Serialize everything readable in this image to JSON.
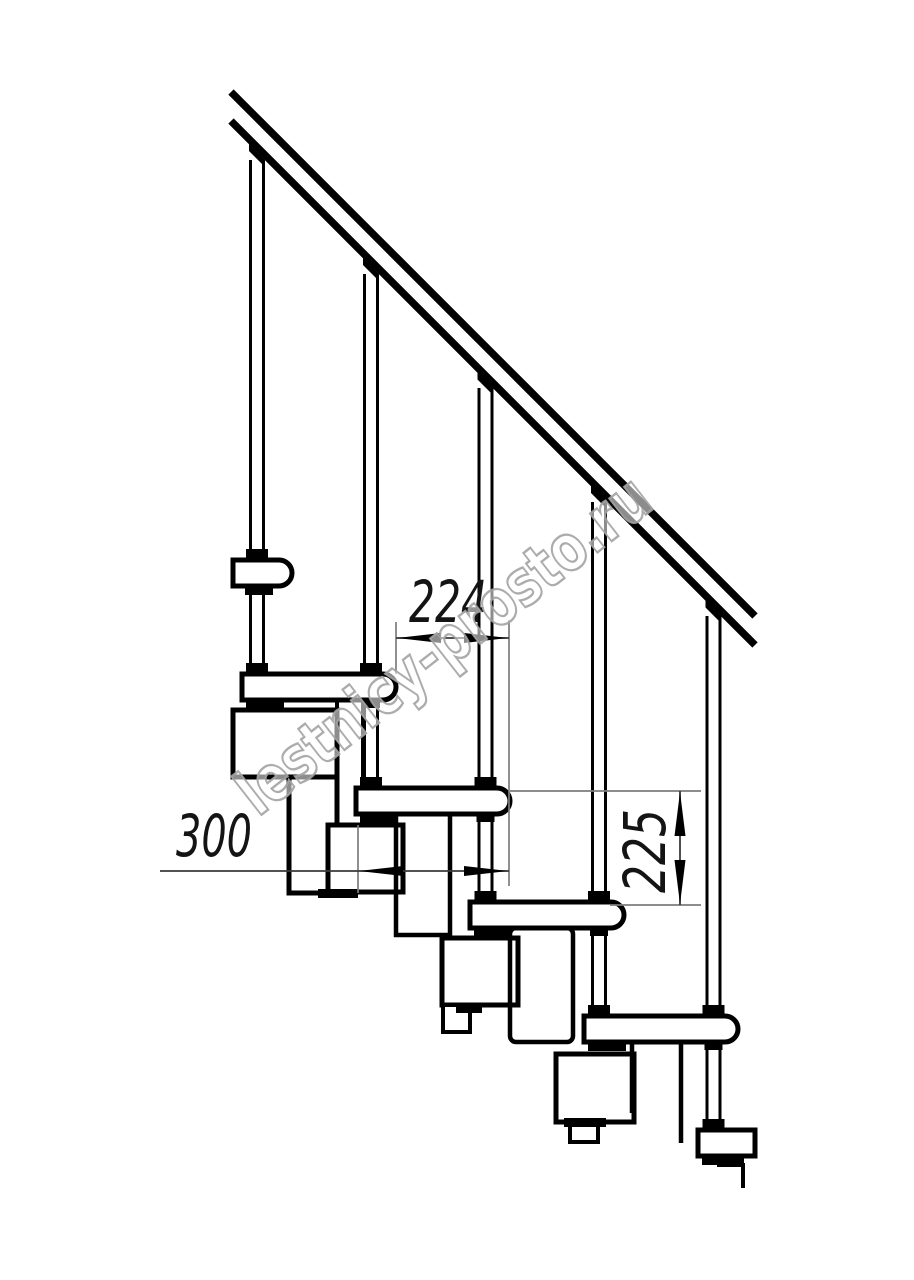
{
  "page": {
    "width": 914,
    "height": 1280,
    "background": "#ffffff"
  },
  "drawing": {
    "subject": "modular staircase side-view technical drawing",
    "line_color": "#000000",
    "dim_line_color": "#3a3a3a",
    "ext_line_color": "#7d7d7d",
    "tread_count_visible": 6,
    "baluster_count": 5
  },
  "dimensions": {
    "tread_offset": {
      "label": "224",
      "orientation": "horizontal"
    },
    "tread_depth": {
      "label": "300",
      "orientation": "horizontal"
    },
    "step_rise": {
      "label": "225",
      "orientation": "vertical"
    }
  },
  "watermark": {
    "text": "lestnicy-prosto.ru",
    "fill": "#ffffff",
    "outline_color": "#a3a3a3"
  }
}
